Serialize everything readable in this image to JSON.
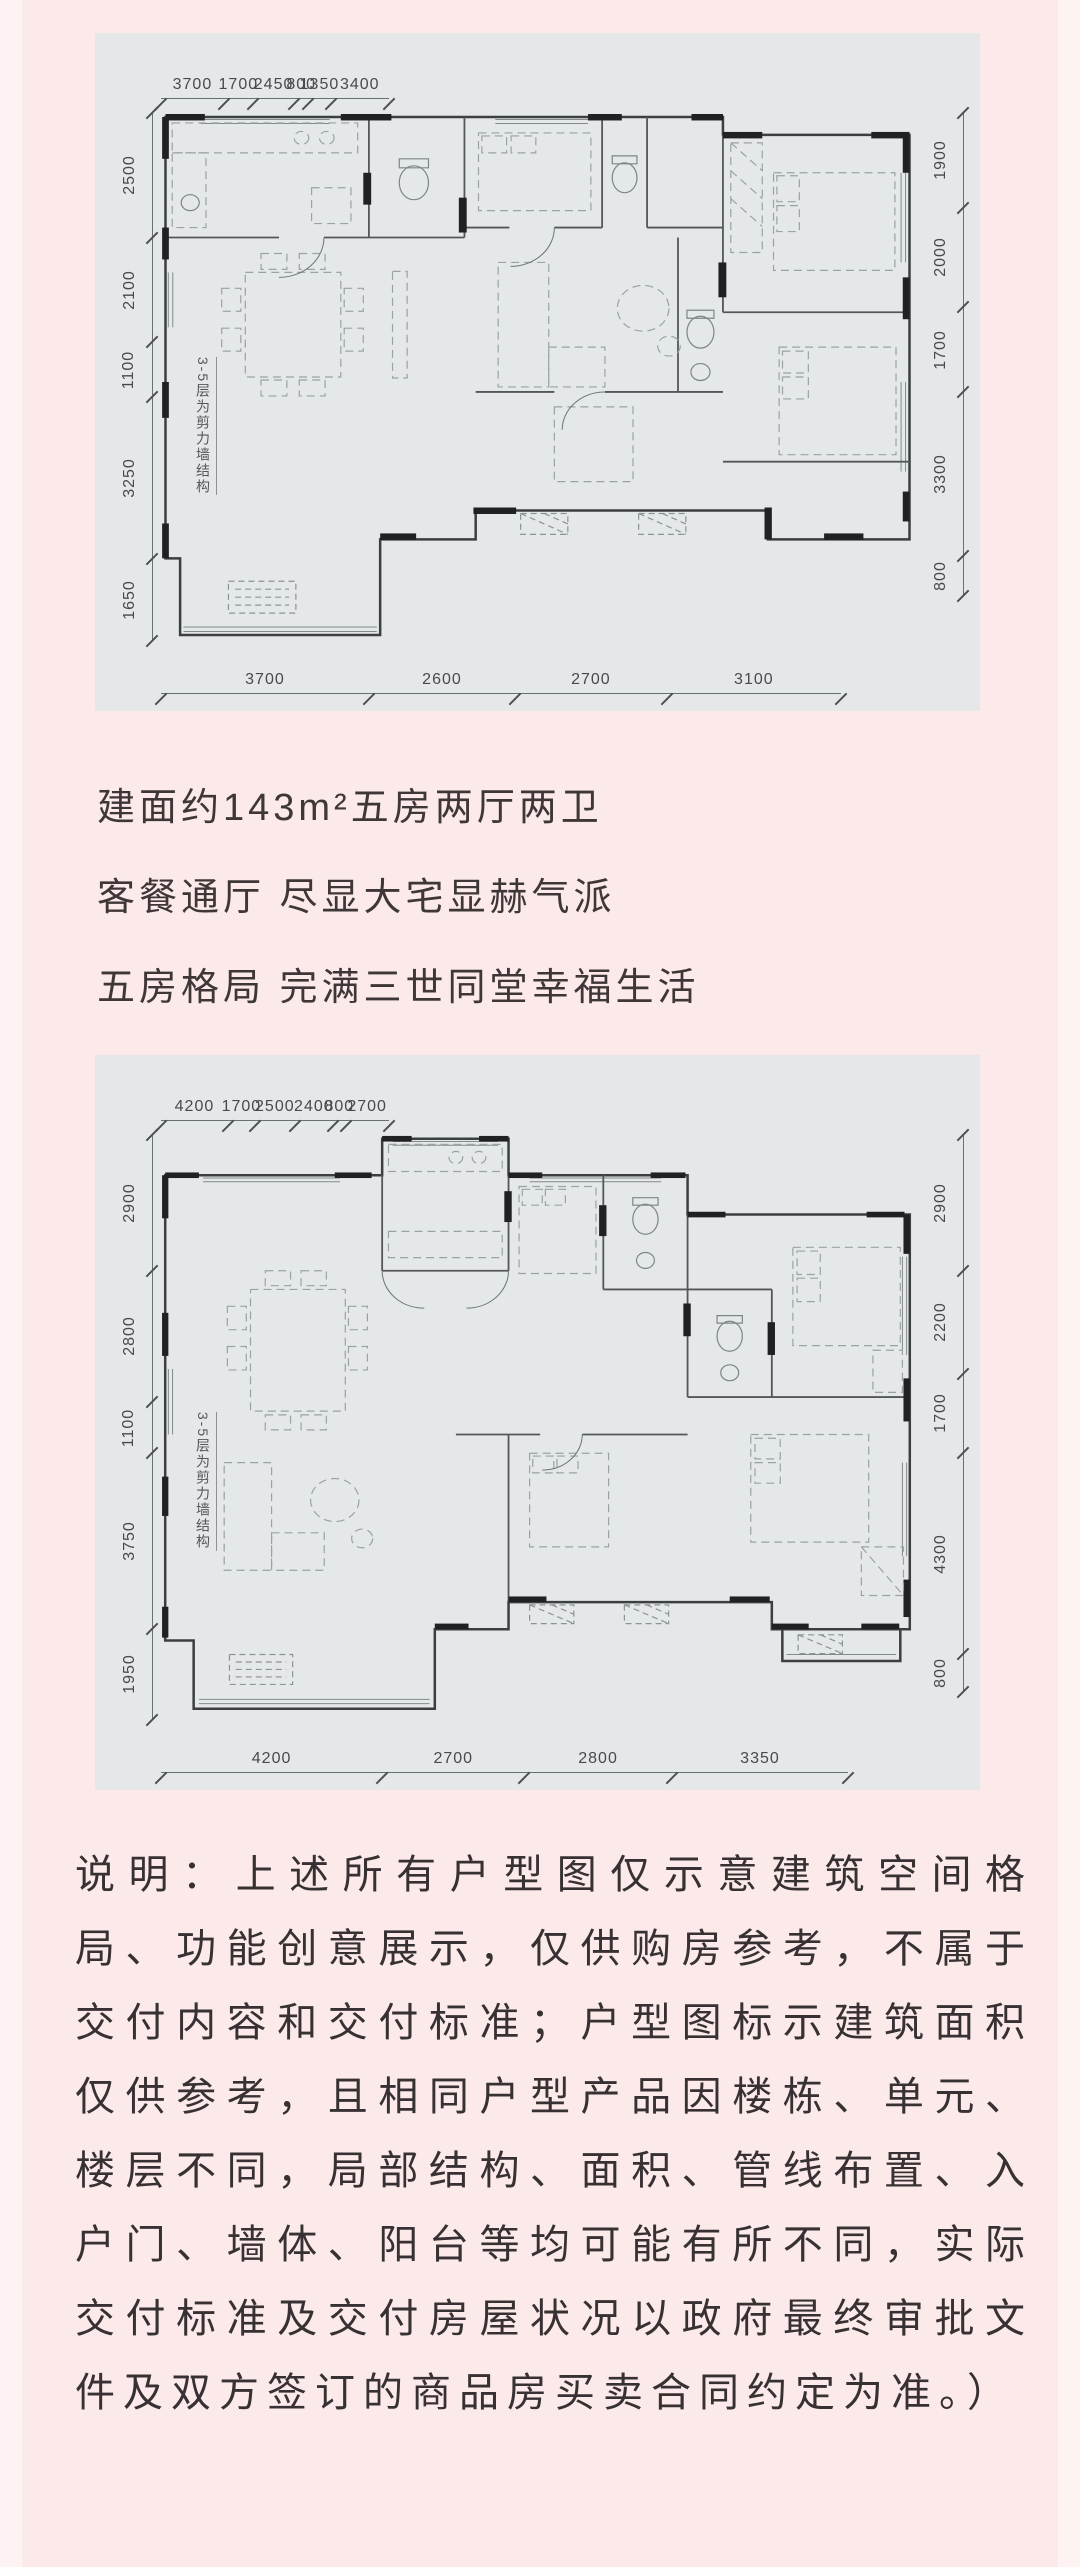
{
  "page": {
    "background": "#fbeae9",
    "panel_background": "#e5e8e9",
    "headline_color": "#3f3638",
    "body_text_color": "#383133"
  },
  "headline": {
    "lines": [
      "建面约143m²五房两厅两卫",
      "客餐通厅 尽显大宅显赫气派",
      "五房格局 完满三世同堂幸福生活"
    ]
  },
  "floorplans": [
    {
      "id": "plan-143",
      "structure_note": "3-5层为剪力墙结构",
      "dims": {
        "top": [
          3700,
          1700,
          2450,
          800,
          1350,
          3400
        ],
        "left": [
          2500,
          2100,
          1100,
          3250,
          1650
        ],
        "right": [
          1900,
          2000,
          1700,
          3300,
          800
        ],
        "bottom": [
          3700,
          2600,
          2700,
          3100
        ]
      }
    },
    {
      "id": "plan-2",
      "structure_note": "3-5层为剪力墙结构",
      "dims": {
        "top": [
          4200,
          1700,
          2500,
          2400,
          800,
          2700
        ],
        "left": [
          2900,
          2800,
          1100,
          3750,
          1950
        ],
        "right": [
          2900,
          2200,
          1700,
          4300,
          800
        ],
        "bottom": [
          4200,
          2700,
          2800,
          3350
        ]
      }
    }
  ],
  "disclaimer": "说明：上述所有户型图仅示意建筑空间格局、功能创意展示，仅供购房参考，不属于交付内容和交付标准；户型图标示建筑面积仅供参考，且相同户型产品因楼栋、单元、楼层不同，局部结构、面积、管线布置、入户门、墙体、阳台等均可能有所不同，实际交付标准及交付房屋状况以政府最终审批文件及双方签订的商品房买卖合同约定为准。）"
}
